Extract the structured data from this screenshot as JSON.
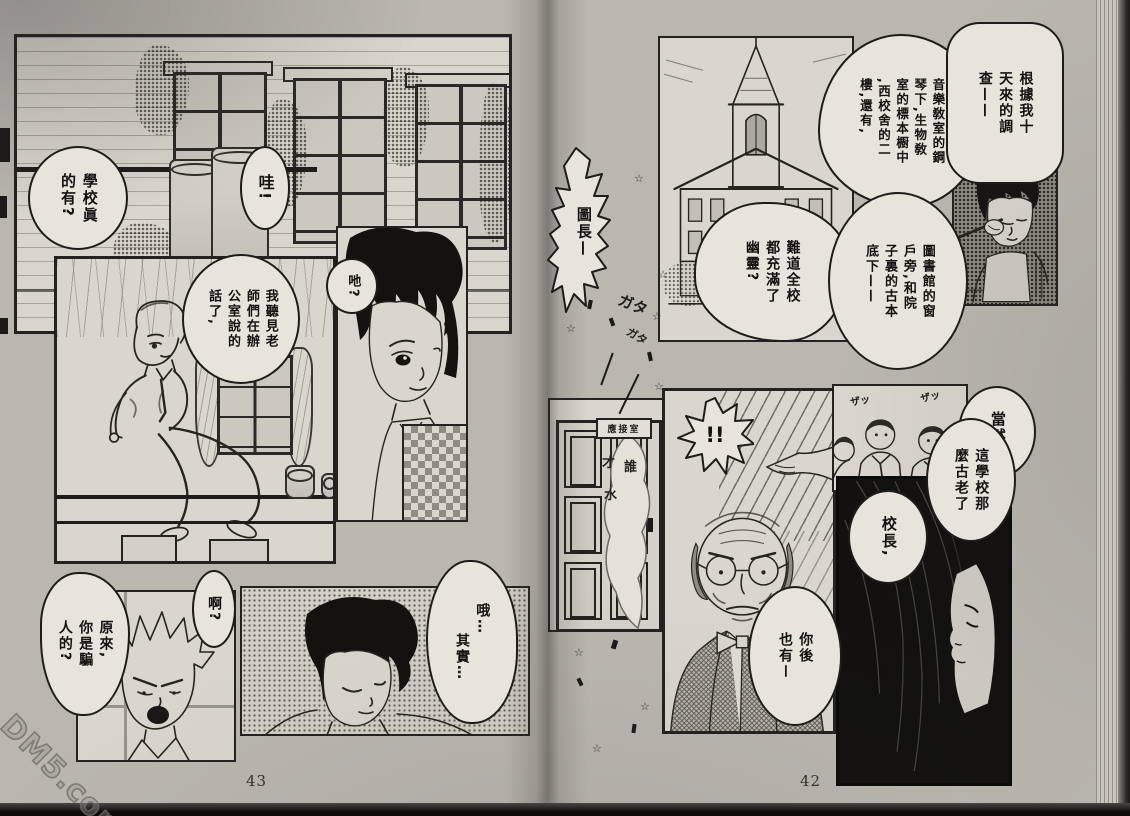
{
  "watermark": "DM5.com",
  "left_page": {
    "page_number": "43",
    "bubble_school": [
      "學校眞",
      "的有?"
    ],
    "bubble_wow": "哇!",
    "bubble_heard": [
      "我聽見老",
      "師們在辦",
      "公室說的",
      "話了,"
    ],
    "bubble_eh": "吔?",
    "bubble_liar": [
      "原來,",
      "你是騙",
      "人的?"
    ],
    "bubble_ah": "啊?",
    "bubble_well": [
      "哦…",
      "其實…"
    ]
  },
  "right_page": {
    "page_number": "42",
    "bubble_research": [
      "根據我十",
      "天來的調",
      "查——"
    ],
    "bubble_locations_a": [
      "音樂敎室的鋼",
      "琴下,生物敎",
      "室的標本櫉中",
      ",西校舍的二",
      "樓,還有,"
    ],
    "bubble_locations_b": [
      "圖書館的窗",
      "戶旁,和院",
      "子裏的古本",
      "底下——"
    ],
    "bubble_director": "圖長—",
    "bubble_ghost_question": [
      "難道全校",
      "都充滿了",
      "幽靈?"
    ],
    "door_sign": "應接室",
    "ghost_whisper": [
      "才",
      "誰",
      "水"
    ],
    "bubble_bang": "!!",
    "bubble_of_course": "當然,",
    "bubble_old_school": [
      "這學校那",
      "麼古老了"
    ],
    "bubble_principal": "校長,",
    "bubble_you_too": [
      "你後",
      "也有ー"
    ]
  },
  "sfx": {
    "gata": "ガタ",
    "za": "ザッ",
    "star": "☆"
  }
}
